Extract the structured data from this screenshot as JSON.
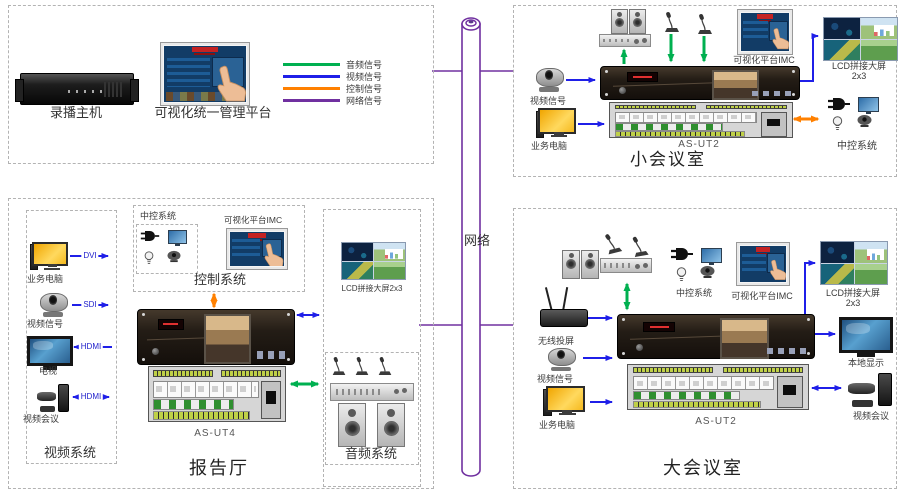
{
  "colors": {
    "audio": "#00b050",
    "video": "#1f1fe8",
    "control": "#ff8000",
    "network": "#7030a0"
  },
  "network": {
    "label": "网络"
  },
  "headend": {
    "recorder": "录播主机",
    "platform": "可视化统一管理平台"
  },
  "legend": {
    "items": [
      {
        "label": "音频信号",
        "color": "#00b050"
      },
      {
        "label": "视频信号",
        "color": "#1f1fe8"
      },
      {
        "label": "控制信号",
        "color": "#ff8000"
      },
      {
        "label": "网络信号",
        "color": "#7030a0"
      }
    ]
  },
  "small_room": {
    "title": "小会议室",
    "unit": "AS-UT2",
    "camera": "视频信号",
    "pc": "业务电脑",
    "imc": "可视化平台IMC",
    "lcd": "LCD拼接大屏",
    "lcd_size": "2x3",
    "central": "中控系统"
  },
  "hall": {
    "title": "报告厅",
    "unit": "AS-UT4",
    "video_system": {
      "title": "视频系统",
      "items": [
        {
          "label": "业务电脑",
          "conn": "DVI"
        },
        {
          "label": "视频信号",
          "conn": "SDI"
        },
        {
          "label": "电视",
          "conn": "HDMI"
        },
        {
          "label": "视频会议",
          "conn": "HDMI"
        }
      ]
    },
    "control_system": {
      "title": "控制系统",
      "central": "中控系统",
      "imc": "可视化平台IMC"
    },
    "lcd": "LCD拼接大屏2x3",
    "audio_system": {
      "title": "音频系统"
    }
  },
  "large_room": {
    "title": "大会议室",
    "unit": "AS-UT2",
    "wireless": "无线投屏",
    "camera": "视频信号",
    "pc": "业务电脑",
    "central": "中控系统",
    "imc": "可视化平台IMC",
    "lcd": "LCD拼接大屏",
    "lcd_size": "2x3",
    "display": "本地显示",
    "vc": "视频会议"
  }
}
